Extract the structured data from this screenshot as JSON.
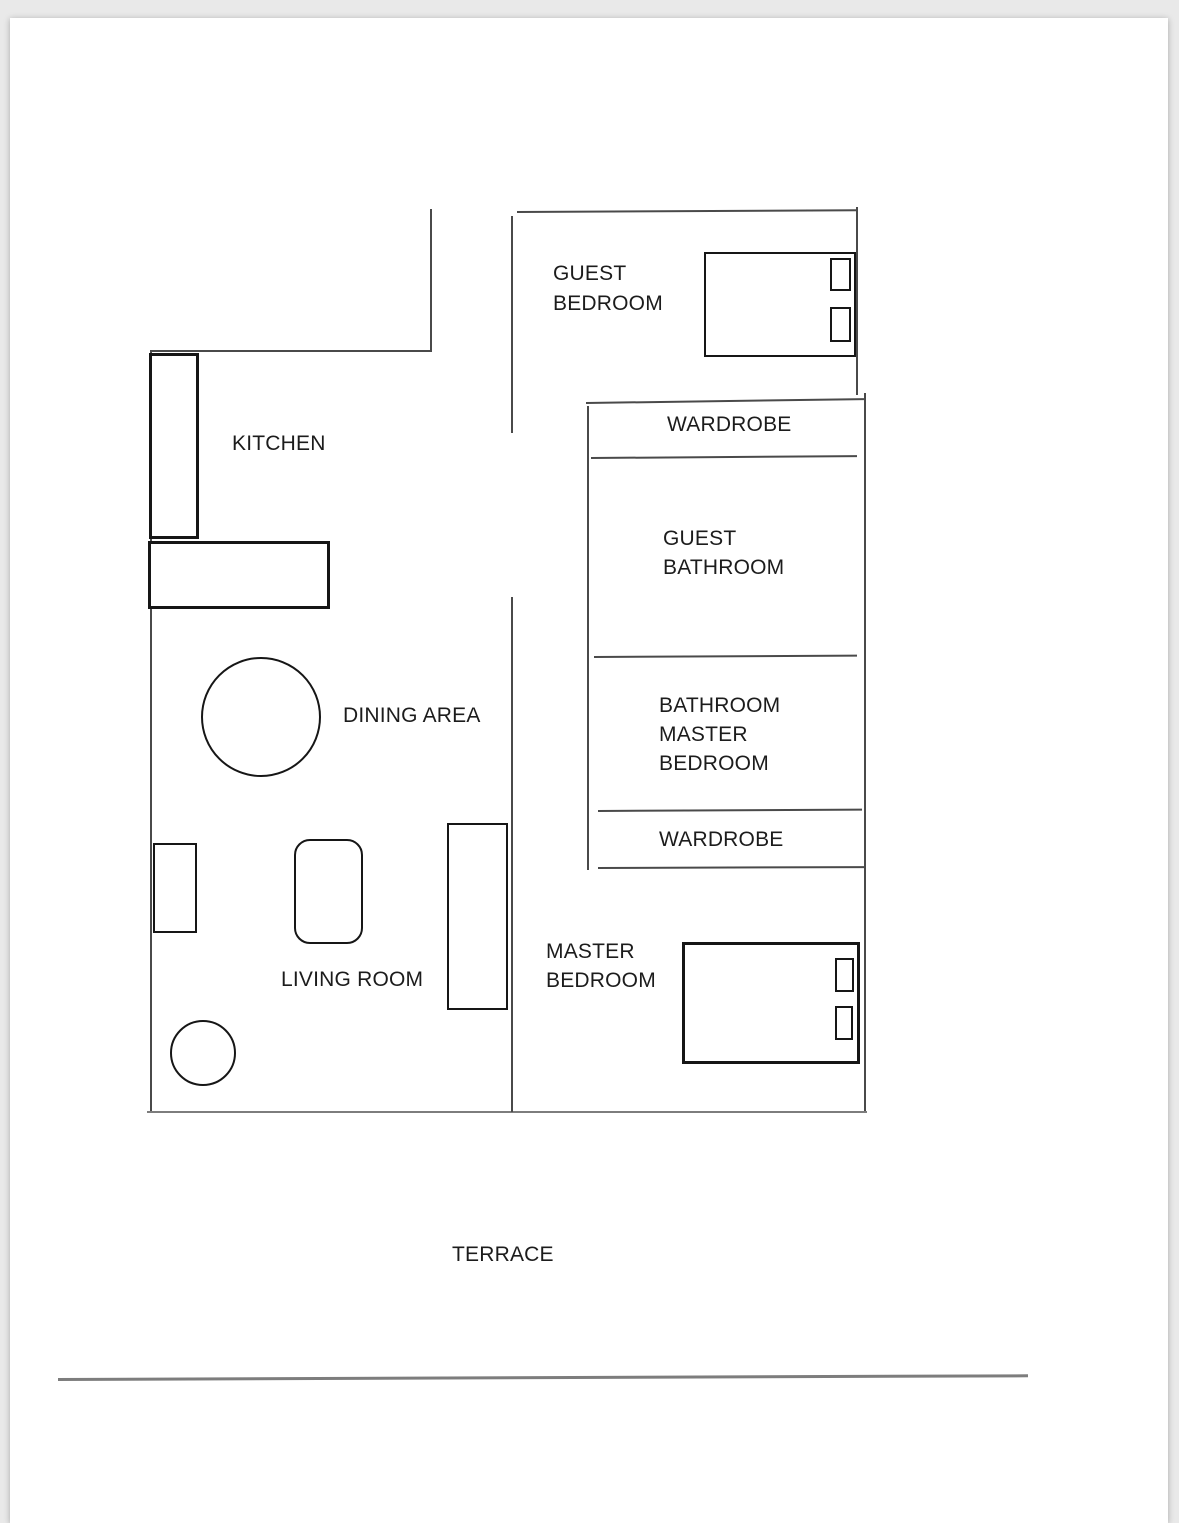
{
  "document": {
    "type": "apartment-floor-plan"
  },
  "colors": {
    "canvas_background": "#e9e9e9",
    "page_background": "#ffffff",
    "wall_line": "#4a4a4a",
    "wall_line_light": "#7d7d7d",
    "furniture_line": "#161616",
    "label_text": "#1c1c1c"
  },
  "rooms": {
    "guest_bedroom": {
      "label": "GUEST\nBEDROOM"
    },
    "kitchen": {
      "label": "KITCHEN"
    },
    "wardrobe_top": {
      "label": "WARDROBE"
    },
    "guest_bathroom": {
      "label": "GUEST\nBATHROOM"
    },
    "master_bathroom": {
      "label": "BATHROOM\nMASTER\nBEDROOM"
    },
    "wardrobe_bottom": {
      "label": "WARDROBE"
    },
    "dining_area": {
      "label": "DINING AREA"
    },
    "living_room": {
      "label": "LIVING ROOM"
    },
    "master_bedroom": {
      "label": "MASTER\nBEDROOM"
    },
    "terrace": {
      "label": "TERRACE"
    }
  }
}
